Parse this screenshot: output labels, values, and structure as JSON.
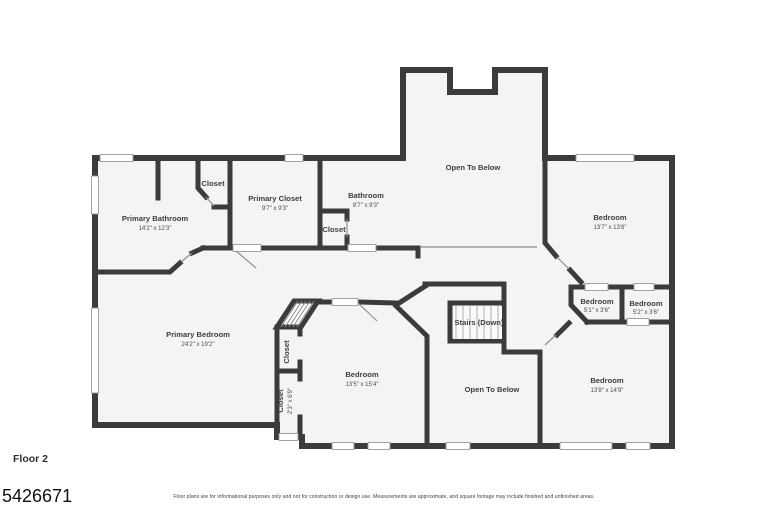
{
  "floor_plan": {
    "floor_label": "Floor 2",
    "listing_number": "5426671",
    "disclaimer": "Floor plans are for informational purposes only and not for construction or design use. Measurements are approximate, and square footage may include finished and unfinished areas.",
    "colors": {
      "wall": "#3b3b3b",
      "room_fill": "#f4f4f4",
      "label_text": "#3d3d3d"
    },
    "rooms": {
      "closet_top_left": {
        "name": "Closet",
        "dims": ""
      },
      "primary_closet": {
        "name": "Primary Closet",
        "dims": "9'7\" x 9'3\""
      },
      "bathroom": {
        "name": "Bathroom",
        "dims": "8'7\" x 9'3\""
      },
      "closet_hall": {
        "name": "Closet",
        "dims": ""
      },
      "primary_bathroom": {
        "name": "Primary Bathroom",
        "dims": "14'2\" x 12'3\""
      },
      "open_to_below_top": {
        "name": "Open To Below",
        "dims": ""
      },
      "bedroom_top_right": {
        "name": "Bedroom",
        "dims": "13'7\" x 13'8\""
      },
      "primary_bedroom": {
        "name": "Primary Bedroom",
        "dims": "24'2\" x 19'2\""
      },
      "closet_upper": {
        "name": "Closet",
        "dims": ""
      },
      "closet_lower": {
        "name": "Closet",
        "dims": "2'3\" x 6'9\""
      },
      "bedroom_bottom_left": {
        "name": "Bedroom",
        "dims": "13'5\" x 15'4\""
      },
      "stairs": {
        "name": "Stairs (Down)",
        "dims": ""
      },
      "bedroom_small_left": {
        "name": "Bedroom",
        "dims": "5'1\" x 3'6\""
      },
      "bedroom_small_right": {
        "name": "Bedroom",
        "dims": "5'2\" x 3'6\""
      },
      "open_to_below_bottom": {
        "name": "Open To Below",
        "dims": ""
      },
      "bedroom_bottom_right": {
        "name": "Bedroom",
        "dims": "13'8\" x 14'9\""
      }
    }
  }
}
